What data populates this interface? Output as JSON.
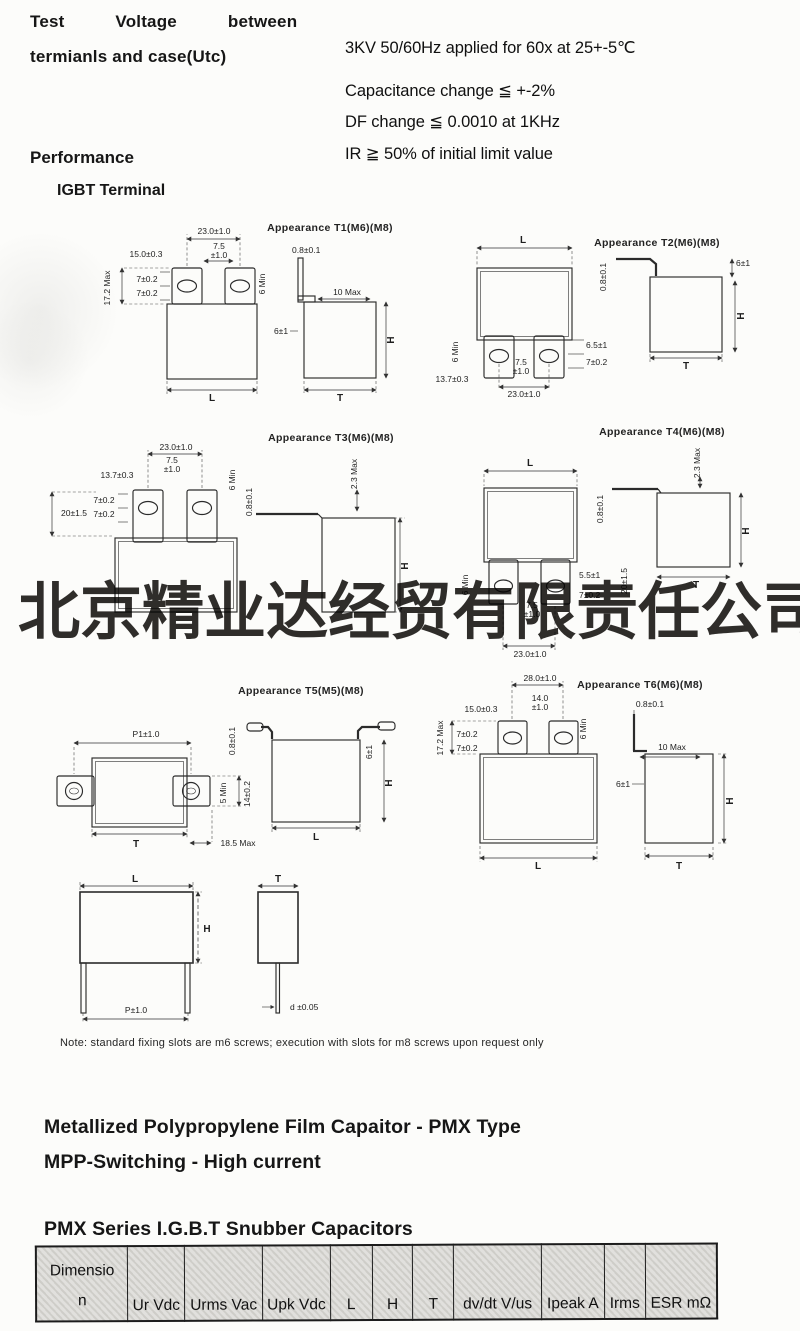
{
  "header": {
    "label_line1": "Test Voltage between",
    "label_line2": "termianls and case(Utc)",
    "specs": [
      "3KV 50/60Hz applied for 60x at 25+-5℃",
      "Capacitance change ≦ +-2%",
      "DF change ≦ 0.0010 at 1KHz",
      "IR ≧ 50% of initial limit value"
    ],
    "performance": "Performance",
    "igbt_terminal": "IGBT Terminal"
  },
  "watermark": "北京精业达经贸有限责任公司",
  "diagrams": {
    "t1": {
      "title": "Appearance T1(M6)(M8)",
      "pitch": "23.0±1.0",
      "tab_w_a": "7.5",
      "tab_w_b": "±1.0",
      "edge": "15.0±0.3",
      "slot_a": "7±0.2",
      "slot_b": "7±0.2",
      "height_max": "17.2 Max",
      "tab_min": "6 Min",
      "thickness": "0.8±0.1",
      "foot_max": "10 Max",
      "offset": "6±1",
      "dim_l": "L",
      "dim_h": "H",
      "dim_t": "T"
    },
    "t2": {
      "title": "Appearance T2(M6)(M8)",
      "dim_l": "L",
      "tab_min": "6 Min",
      "edge": "13.7±0.3",
      "tab_w_a": "7.5",
      "tab_w_b": "±1.0",
      "pitch": "23.0±1.0",
      "offset_a": "6.5±1",
      "slot": "7±0.2",
      "thickness": "0.8±0.1",
      "offset": "6±1",
      "dim_h": "H",
      "dim_t": "T"
    },
    "t3": {
      "title": "Appearance T3(M6)(M8)",
      "pitch": "23.0±1.0",
      "tab_w_a": "7.5",
      "tab_w_b": "±1.0",
      "edge": "13.7±0.3",
      "tab_len": "20±1.5",
      "slot_a": "7±0.2",
      "slot_b": "7±0.2",
      "tab_min": "6 Min",
      "thickness": "0.8±0.1",
      "lead_max": "2.3 Max",
      "dim_h": "H"
    },
    "t4": {
      "title": "Appearance T4(M6)(M8)",
      "dim_l": "L",
      "lead_max": "2.3 Max",
      "thickness": "0.8±0.1",
      "dim_h": "H",
      "dim_t": "T",
      "tab_min": "6 Min",
      "offset_a": "5.5±1",
      "tab_len": "20±1.5",
      "slot": "7±0.2",
      "tab_w_a": "7.5",
      "tab_w_b": "±1.0",
      "pitch": "23.0±1.0"
    },
    "t5": {
      "title": "Appearance T5(M5)(M8)",
      "pitch": "P1±1.0",
      "tab_min": "5 Min",
      "tab_w": "14±0.2",
      "dim_t": "T",
      "len_max": "18.5 Max",
      "thickness": "0.8±0.1",
      "dim_l": "L",
      "offset": "6±1",
      "dim_h": "H"
    },
    "t6": {
      "title": "Appearance T6(M6)(M8)",
      "pitch": "28.0±1.0",
      "tab_w_a": "14.0",
      "tab_w_b": "±1.0",
      "edge": "15.0±0.3",
      "height_max": "17.2 Max",
      "slot_a": "7±0.2",
      "slot_b": "7±0.2",
      "tab_min": "6 Min",
      "thickness": "0.8±0.1",
      "foot_max": "10 Max",
      "offset": "6±1",
      "dim_l": "L",
      "dim_t": "T",
      "dim_h": "H"
    },
    "t7": {
      "dim_l": "L",
      "dim_h": "H",
      "dim_t": "T",
      "pitch": "P±1.0",
      "lead_d": "d ±0.05"
    }
  },
  "note": "Note: standard fixing slots are m6 screws; execution with slots for m8 screws upon request only",
  "sections": {
    "title1": "Metallized Polypropylene Film Capaitor - PMX Type",
    "title2": "MPP-Switching - High current",
    "table_title": "PMX Series I.G.B.T Snubber Capacitors"
  },
  "table": {
    "headers": [
      "Dimensio\nn",
      "Ur Vdc",
      "Urms Vac",
      "Upk Vdc",
      "L",
      "H",
      "T",
      "dv/dt V/us",
      "Ipeak A",
      "Irms",
      "ESR mΩ"
    ]
  }
}
